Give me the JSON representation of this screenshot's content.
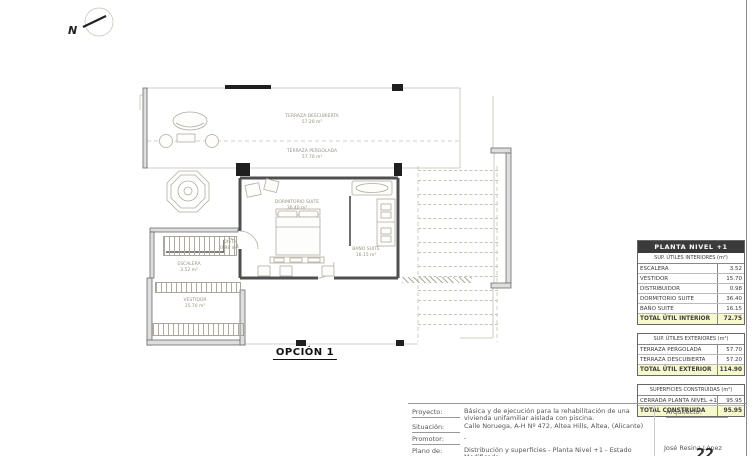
{
  "plan": {
    "caption": "OPCIÓN 1",
    "north_label": "N",
    "rooms": {
      "terraza_descubierta": {
        "name": "TERRAZA DESCUBIERTA",
        "area": "57.20 m²"
      },
      "terraza_pergolada": {
        "name": "TERRAZA PERGOLADA",
        "area": "57.70 m²"
      },
      "dormitorio_suite": {
        "name": "DORMITORIO SUITE",
        "area": "36.40 m²"
      },
      "bano_suite": {
        "name": "BAÑO SUITE",
        "area": "16.15 m²"
      },
      "escalera": {
        "name": "ESCALERA",
        "area": "3.52 m²"
      },
      "vestidor": {
        "name": "VESTIDOR",
        "area": "15.70 m²"
      },
      "distribuidor": {
        "name": "DIST.",
        "area": "0.98 m²"
      }
    }
  },
  "summary": {
    "title": "PLANTA NIVEL +1",
    "interior": {
      "header": "SUP. ÚTILES INTERIORES (m²)",
      "rows": [
        {
          "label": "ESCALERA",
          "value": "3.52"
        },
        {
          "label": "VESTIDOR",
          "value": "15.70"
        },
        {
          "label": "DISTRIBUIDOR",
          "value": "0.98"
        },
        {
          "label": "DORMITORIO SUITE",
          "value": "36.40"
        },
        {
          "label": "BAÑO SUITE",
          "value": "16.15"
        }
      ],
      "total_label": "TOTAL ÚTIL INTERIOR",
      "total_value": "72.75"
    },
    "exterior": {
      "header": "SUP. ÚTILES EXTERIORES (m²)",
      "rows": [
        {
          "label": "TERRAZA PERGOLADA",
          "value": "57.70"
        },
        {
          "label": "TERRAZA DESCUBIERTA",
          "value": "57.20"
        }
      ],
      "total_label": "TOTAL ÚTIL EXTERIOR",
      "total_value": "114.90"
    },
    "construida": {
      "header": "SUPERFICIES CONSTRUIDAS (m²)",
      "rows": [
        {
          "label": "CERRADA PLANTA NIVEL +1",
          "value": "95.95"
        }
      ],
      "total_label": "TOTAL CONSTRUIDA",
      "total_value": "95.95"
    }
  },
  "titleblock": {
    "fields": [
      {
        "label": "Proyecto:",
        "value": "Básica y de ejecución para la rehabilitación de una vivienda unifamiliar aislada con piscina."
      },
      {
        "label": "Situación:",
        "value": "Calle Noruega, A-H Nº 472, Altea Hills, Altea, (Alicante)"
      },
      {
        "label": "Promotor:",
        "value": "-"
      },
      {
        "label": "Plano de:",
        "value": "Distribución y superficies - Planta Nivel +1 - Estado Modificado"
      }
    ],
    "architect_label": "Arquitecto:",
    "architect_name": "José Resina López",
    "sheet_number": "22"
  },
  "colors": {
    "total_bg": "#f8f8cd",
    "header_bg": "#3b3b3b",
    "header_text": "#ffffff"
  }
}
